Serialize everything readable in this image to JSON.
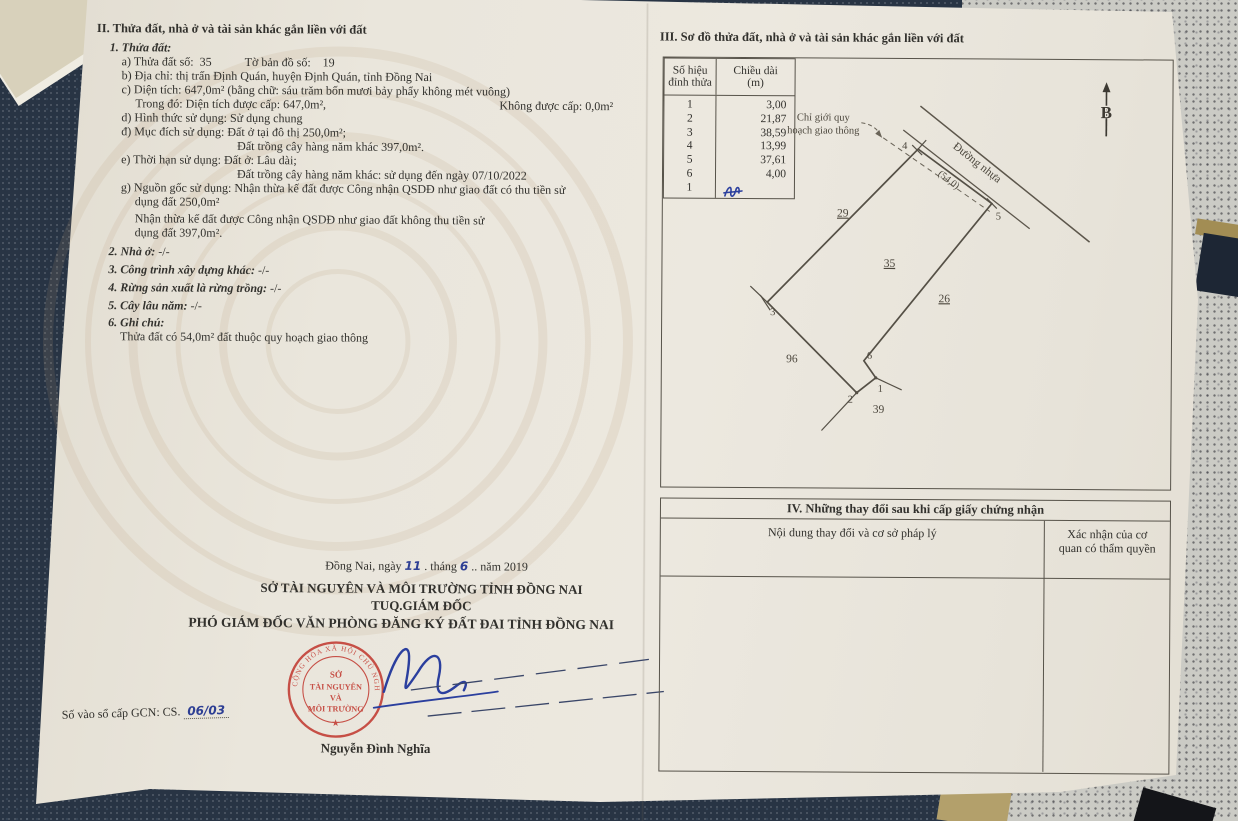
{
  "section2": {
    "title": "II. Thửa đất, nhà ở và tài sản khác gắn liền với đất",
    "sub1_title": "1. Thửa đất:",
    "a_label": "a) Thửa đất số:",
    "a_value": "35",
    "a2_label": "Tờ bản đồ số:",
    "a2_value": "19",
    "b": "b) Địa chỉ: thị trấn Định Quán, huyện Định Quán, tỉnh Đồng Nai",
    "c": "c) Diện tích: 647,0m² (bằng chữ: sáu trăm bốn mươi bảy phẩy không mét vuông)",
    "c2a": "Trong đó: Diện tích được cấp: 647,0m²,",
    "c2b": "Không được cấp: 0,0m²",
    "d": "d) Hình thức sử dụng: Sử dụng chung",
    "dd": "đ) Mục đích sử dụng: Đất ở tại đô thị 250,0m²;",
    "dd2": "Đất trồng cây hàng năm khác 397,0m².",
    "e": "e) Thời hạn sử dụng: Đất ở: Lâu dài;",
    "e2": "Đất trồng cây hàng năm khác: sử dụng đến ngày 07/10/2022",
    "g1": "g) Nguồn gốc sử dụng: Nhận thừa kế đất được Công nhận QSDĐ như giao đất có thu tiền sử",
    "g2": "dụng đất 250,0m²",
    "g3": "Nhận thừa kế đất được Công nhận QSDĐ như giao đất không thu tiền sử",
    "g4": "dụng đất 397,0m².",
    "item2_label": "2. Nhà ở:",
    "item2_value": "-/-",
    "item3_label": "3. Công trình xây dựng khác:",
    "item3_value": "-/-",
    "item4_label": "4. Rừng sản xuất là rừng trồng:",
    "item4_value": "-/-",
    "item5_label": "5. Cây lâu năm:",
    "item5_value": "-/-",
    "item6_label": "6. Ghi chú:",
    "item6_note": "Thửa đất có 54,0m² đất thuộc quy hoạch giao thông"
  },
  "section3": {
    "title": "III. Sơ đồ thửa đất, nhà ở và tài sản khác gắn liền với đất",
    "diagram": {
      "north_label": "B",
      "road_label": "Đường nhựa",
      "planning_line1": "Chỉ giới quy",
      "planning_line2": "hoạch giao thông",
      "frontage_dim": "(54,0)",
      "parcel_label": "35",
      "neighbor_top_left": "29",
      "neighbor_right": "26",
      "neighbor_bottom_left": "96",
      "neighbor_bottom": "39",
      "v1": "1",
      "v2": "2",
      "v3": "3",
      "v4": "4",
      "v5": "5",
      "v6": "6"
    },
    "table": {
      "header_col1_line1": "Số hiệu",
      "header_col1_line2": "đỉnh thửa",
      "header_col2_line1": "Chiều dài",
      "header_col2_line2": "(m)",
      "rows": [
        {
          "vertex": "1",
          "length": "3,00"
        },
        {
          "vertex": "2",
          "length": "21,87"
        },
        {
          "vertex": "3",
          "length": "38,59"
        },
        {
          "vertex": "4",
          "length": "13,99"
        },
        {
          "vertex": "5",
          "length": "37,61"
        },
        {
          "vertex": "6",
          "length": "4,00"
        },
        {
          "vertex": "1",
          "length": ""
        }
      ]
    }
  },
  "section4": {
    "title": "IV. Những thay đổi sau khi cấp giấy chứng nhận",
    "col1_header": "Nội dung thay đổi và cơ sở pháp lý",
    "col2_header_line1": "Xác nhận của cơ",
    "col2_header_line2": "quan có thẩm quyền"
  },
  "signature": {
    "date_prefix": "Đồng Nai, ngày",
    "day": "11",
    "date_mid": ". tháng",
    "month": "6",
    "date_suffix": " .. năm 2019",
    "org1": "SỞ TÀI NGUYÊN VÀ MÔI TRƯỜNG TỈNH ĐỒNG NAI",
    "org2": "TUQ.GIÁM ĐỐC",
    "org3": "PHÓ GIÁM ĐỐC VĂN PHÒNG ĐĂNG KÝ ĐẤT ĐAI TỈNH ĐỒNG NAI",
    "signer": "Nguyễn Đình Nghĩa",
    "gcn_label": "Số vào sổ cấp GCN: CS.",
    "gcn_value": "06/03",
    "stamp": {
      "ring_text": "CỘNG HÒA XÃ HỘI CHỦ NGHĨA VIỆT NAM",
      "line1": "SỞ",
      "line2": "TÀI NGUYÊN",
      "line3": "VÀ",
      "line4": "MÔI TRƯỜNG"
    }
  },
  "colors": {
    "stamp_red": "#c23b32",
    "ink_blue": "#2e3f94"
  }
}
